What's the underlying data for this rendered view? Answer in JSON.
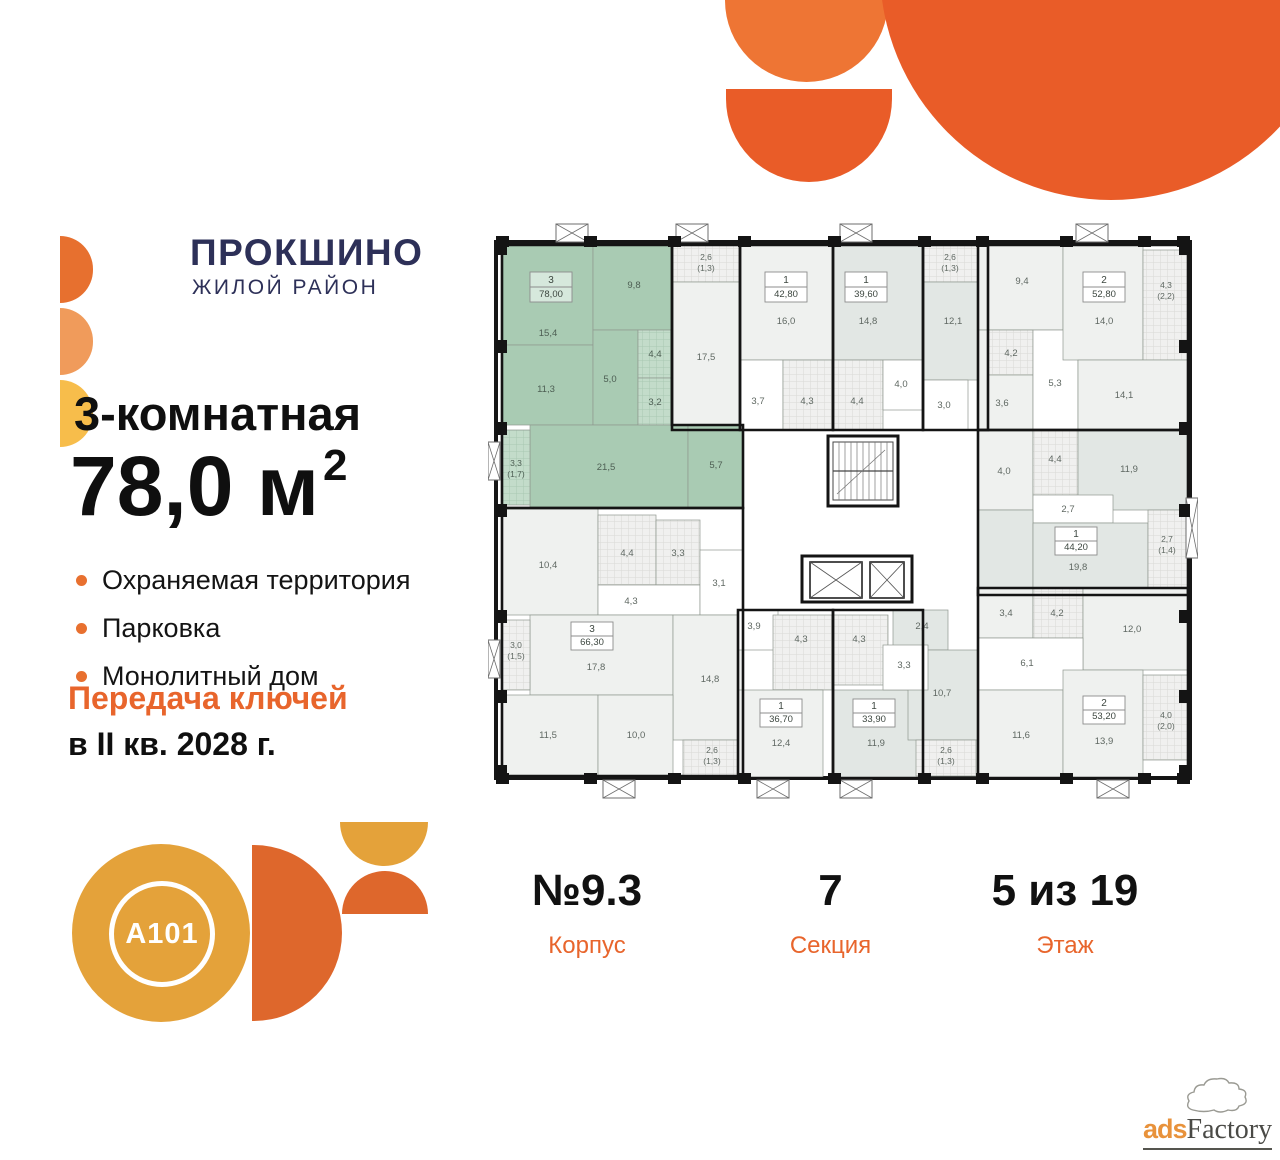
{
  "brand": {
    "name": "ПРОКШИНΟ",
    "subtitle": "ЖИЛОЙ РАЙОН"
  },
  "listing": {
    "rooms_title": "3-комнатная",
    "area_main": "78,0 м",
    "area_sup": "2",
    "features": [
      "Охраняемая территория",
      "Парковка",
      "Монолитный дом"
    ],
    "keys_line1": "Передача ключей",
    "keys_line2": "в II кв. 2028 г."
  },
  "footer": {
    "items": [
      {
        "value": "№9.3",
        "label": "Корпус"
      },
      {
        "value": "7",
        "label": "Секция"
      },
      {
        "value": "5 из 19",
        "label": "Этаж"
      }
    ]
  },
  "developer": {
    "logo_text": "A101"
  },
  "watermark": {
    "prefix": "ads",
    "suffix": "Factory"
  },
  "colors": {
    "accent": "#E8652C",
    "navy": "#2D3058",
    "highlight_green": "#A9CBB3"
  },
  "floorplan": {
    "colors": {
      "green": "#a9cbb3",
      "greenTile": "url(#ptg)",
      "light": "#eff1ef",
      "dark": "#e2e7e4",
      "tile": "url(#pt)",
      "corr": "#ffffff"
    },
    "rooms": [
      {
        "id": "g-15-4",
        "x": 14,
        "y": 25,
        "w": 91,
        "h": 100,
        "f": "green",
        "l": "15,4",
        "lx": 60,
        "ly": 116
      },
      {
        "id": "g-9-8",
        "x": 105,
        "y": 25,
        "w": 79,
        "h": 85,
        "f": "green",
        "l": "9,8",
        "lx": 146,
        "ly": 68
      },
      {
        "id": "g-11-3",
        "x": 14,
        "y": 125,
        "w": 91,
        "h": 80,
        "f": "green",
        "l": "11,3",
        "lx": 58,
        "ly": 172
      },
      {
        "id": "g-5-0",
        "x": 105,
        "y": 110,
        "w": 45,
        "h": 95,
        "f": "green",
        "l": "5,0",
        "lx": 122,
        "ly": 162
      },
      {
        "id": "g-4-4",
        "x": 150,
        "y": 110,
        "w": 34,
        "h": 48,
        "f": "greenTile",
        "l": "4,4",
        "lx": 167,
        "ly": 137
      },
      {
        "id": "g-3-2",
        "x": 150,
        "y": 158,
        "w": 34,
        "h": 47,
        "f": "greenTile",
        "l": "3,2",
        "lx": 167,
        "ly": 185
      },
      {
        "id": "g-21-5",
        "x": 42,
        "y": 205,
        "w": 158,
        "h": 83,
        "f": "green",
        "l": "21,5",
        "lx": 118,
        "ly": 250
      },
      {
        "id": "g-5-7",
        "x": 200,
        "y": 205,
        "w": 55,
        "h": 83,
        "f": "green",
        "l": "5,7",
        "lx": 228,
        "ly": 248
      },
      {
        "id": "g-balc-3-3",
        "x": 14,
        "y": 210,
        "w": 28,
        "h": 75,
        "f": "greenTile",
        "l": "3,3",
        "lx": 28,
        "ly": 246,
        "l2": "(1,7)"
      },
      {
        "id": "t-balc-2-6",
        "x": 184,
        "y": 25,
        "w": 68,
        "h": 37,
        "f": "tile",
        "l": "2,6",
        "lx": 218,
        "ly": 40,
        "l2": "(1,3)"
      },
      {
        "id": "t-17-5",
        "x": 184,
        "y": 62,
        "w": 68,
        "h": 143,
        "f": "light",
        "l": "17,5",
        "lx": 218,
        "ly": 140
      },
      {
        "id": "a-16-0",
        "x": 252,
        "y": 25,
        "w": 93,
        "h": 115,
        "f": "light",
        "l": "16,0",
        "lx": 298,
        "ly": 104
      },
      {
        "id": "a-3-7",
        "x": 252,
        "y": 140,
        "w": 43,
        "h": 70,
        "f": "corr",
        "l": "3,7",
        "lx": 270,
        "ly": 184
      },
      {
        "id": "a-4-3",
        "x": 295,
        "y": 140,
        "w": 50,
        "h": 70,
        "f": "tile",
        "l": "4,3",
        "lx": 319,
        "ly": 184
      },
      {
        "id": "b-14-8",
        "x": 345,
        "y": 25,
        "w": 90,
        "h": 115,
        "f": "dark",
        "l": "14,8",
        "lx": 380,
        "ly": 104
      },
      {
        "id": "b-4-4",
        "x": 345,
        "y": 140,
        "w": 50,
        "h": 70,
        "f": "tile",
        "l": "4,4",
        "lx": 369,
        "ly": 184
      },
      {
        "id": "b-4-0",
        "x": 395,
        "y": 140,
        "w": 40,
        "h": 50,
        "f": "corr",
        "l": "4,0",
        "lx": 413,
        "ly": 167
      },
      {
        "id": "c-balc-2-6",
        "x": 435,
        "y": 25,
        "w": 55,
        "h": 37,
        "f": "tile",
        "l": "2,6",
        "lx": 462,
        "ly": 40,
        "l2": "(1,3)"
      },
      {
        "id": "c-12-1",
        "x": 435,
        "y": 62,
        "w": 65,
        "h": 98,
        "f": "dark",
        "l": "12,1",
        "lx": 465,
        "ly": 104
      },
      {
        "id": "c-3-0",
        "x": 435,
        "y": 160,
        "w": 45,
        "h": 50,
        "f": "corr",
        "l": "3,0",
        "lx": 456,
        "ly": 188
      },
      {
        "id": "d-9-4",
        "x": 490,
        "y": 25,
        "w": 85,
        "h": 85,
        "f": "light",
        "l": "9,4",
        "lx": 534,
        "ly": 64
      },
      {
        "id": "d-3-6",
        "x": 490,
        "y": 110,
        "w": 55,
        "h": 100,
        "f": "light",
        "l": "3,6",
        "lx": 514,
        "ly": 186
      },
      {
        "id": "d-4-2",
        "x": 500,
        "y": 110,
        "w": 45,
        "h": 45,
        "f": "tile",
        "l": "4,2",
        "lx": 523,
        "ly": 136
      },
      {
        "id": "d-5-3",
        "x": 545,
        "y": 110,
        "w": 45,
        "h": 100,
        "f": "corr",
        "l": "5,3",
        "lx": 567,
        "ly": 166
      },
      {
        "id": "d-14-0",
        "x": 575,
        "y": 25,
        "w": 80,
        "h": 115,
        "f": "light",
        "l": "14,0",
        "lx": 616,
        "ly": 104
      },
      {
        "id": "d-balc-4-3",
        "x": 655,
        "y": 30,
        "w": 45,
        "h": 110,
        "f": "tile",
        "l": "4,3",
        "lx": 678,
        "ly": 68,
        "l2": "(2,2)"
      },
      {
        "id": "d-14-1",
        "x": 590,
        "y": 140,
        "w": 110,
        "h": 70,
        "f": "light",
        "l": "14,1",
        "lx": 636,
        "ly": 178
      },
      {
        "id": "e-4-0",
        "x": 490,
        "y": 210,
        "w": 55,
        "h": 80,
        "f": "light",
        "l": "4,0",
        "lx": 516,
        "ly": 254
      },
      {
        "id": "e-4-4",
        "x": 545,
        "y": 210,
        "w": 45,
        "h": 65,
        "f": "tile",
        "l": "4,4",
        "lx": 567,
        "ly": 242
      },
      {
        "id": "e-11-9",
        "x": 590,
        "y": 210,
        "w": 110,
        "h": 80,
        "f": "dark",
        "l": "11,9",
        "lx": 641,
        "ly": 252
      },
      {
        "id": "e-2-7",
        "x": 545,
        "y": 275,
        "w": 80,
        "h": 28,
        "f": "corr",
        "l": "2,7",
        "lx": 580,
        "ly": 292
      },
      {
        "id": "e-kit",
        "x": 490,
        "y": 290,
        "w": 55,
        "h": 85,
        "f": "dark",
        "l": "",
        "lx": 0,
        "ly": 0
      },
      {
        "id": "e-19-8",
        "x": 545,
        "y": 303,
        "w": 115,
        "h": 72,
        "f": "dark",
        "l": "19,8",
        "lx": 590,
        "ly": 350
      },
      {
        "id": "e-balc-2-7",
        "x": 660,
        "y": 290,
        "w": 40,
        "h": 80,
        "f": "tile",
        "l": "2,7",
        "lx": 679,
        "ly": 322,
        "l2": "(1,4)"
      },
      {
        "id": "f-10-4",
        "x": 14,
        "y": 288,
        "w": 96,
        "h": 107,
        "f": "light",
        "l": "10,4",
        "lx": 60,
        "ly": 348
      },
      {
        "id": "f-4-4",
        "x": 110,
        "y": 295,
        "w": 58,
        "h": 70,
        "f": "tile",
        "l": "4,4",
        "lx": 139,
        "ly": 336
      },
      {
        "id": "f-3-3",
        "x": 168,
        "y": 300,
        "w": 44,
        "h": 65,
        "f": "tile",
        "l": "3,3",
        "lx": 190,
        "ly": 336
      },
      {
        "id": "f-4-3",
        "x": 110,
        "y": 365,
        "w": 102,
        "h": 30,
        "f": "corr",
        "l": "4,3",
        "lx": 143,
        "ly": 384
      },
      {
        "id": "f-3-1",
        "x": 212,
        "y": 330,
        "w": 43,
        "h": 65,
        "f": "corr",
        "l": "3,1",
        "lx": 231,
        "ly": 366
      },
      {
        "id": "f-17-8",
        "x": 42,
        "y": 395,
        "w": 143,
        "h": 80,
        "f": "light",
        "l": "17,8",
        "lx": 108,
        "ly": 450
      },
      {
        "id": "f-14-8",
        "x": 185,
        "y": 395,
        "w": 70,
        "h": 125,
        "f": "light",
        "l": "14,8",
        "lx": 222,
        "ly": 462
      },
      {
        "id": "f-balc-3-0",
        "x": 14,
        "y": 400,
        "w": 28,
        "h": 70,
        "f": "tile",
        "l": "3,0",
        "lx": 28,
        "ly": 428,
        "l2": "(1,5)"
      },
      {
        "id": "f-11-5",
        "x": 14,
        "y": 475,
        "w": 96,
        "h": 81,
        "f": "light",
        "l": "11,5",
        "lx": 60,
        "ly": 518
      },
      {
        "id": "f-10-0",
        "x": 110,
        "y": 475,
        "w": 75,
        "h": 81,
        "f": "light",
        "l": "10,0",
        "lx": 148,
        "ly": 518
      },
      {
        "id": "f-balc-2-6",
        "x": 195,
        "y": 520,
        "w": 57,
        "h": 36,
        "f": "tile",
        "l": "2,6",
        "lx": 224,
        "ly": 533,
        "l2": "(1,3)"
      },
      {
        "id": "h-3-9",
        "x": 250,
        "y": 390,
        "w": 40,
        "h": 40,
        "f": "corr",
        "l": "3,9",
        "lx": 266,
        "ly": 409
      },
      {
        "id": "h-4-3",
        "x": 285,
        "y": 395,
        "w": 60,
        "h": 75,
        "f": "tile",
        "l": "4,3",
        "lx": 313,
        "ly": 422
      },
      {
        "id": "h-12-4",
        "x": 250,
        "y": 470,
        "w": 85,
        "h": 88,
        "f": "light",
        "l": "12,4",
        "lx": 293,
        "ly": 526
      },
      {
        "id": "i-4-3",
        "x": 345,
        "y": 395,
        "w": 55,
        "h": 70,
        "f": "tile",
        "l": "4,3",
        "lx": 371,
        "ly": 422
      },
      {
        "id": "i-11-9",
        "x": 345,
        "y": 470,
        "w": 90,
        "h": 88,
        "f": "dark",
        "l": "11,9",
        "lx": 388,
        "ly": 526
      },
      {
        "id": "j-2-4",
        "x": 405,
        "y": 390,
        "w": 55,
        "h": 40,
        "f": "dark",
        "l": "2,4",
        "lx": 434,
        "ly": 409
      },
      {
        "id": "j-10-7",
        "x": 420,
        "y": 430,
        "w": 70,
        "h": 90,
        "f": "dark",
        "l": "10,7",
        "lx": 454,
        "ly": 476
      },
      {
        "id": "j-3-3",
        "x": 395,
        "y": 425,
        "w": 45,
        "h": 45,
        "f": "corr",
        "l": "3,3",
        "lx": 416,
        "ly": 448
      },
      {
        "id": "j-balc-2-6",
        "x": 428,
        "y": 520,
        "w": 60,
        "h": 36,
        "f": "tile",
        "l": "2,6",
        "lx": 458,
        "ly": 533,
        "l2": "(1,3)"
      },
      {
        "id": "k-3-4",
        "x": 490,
        "y": 368,
        "w": 55,
        "h": 50,
        "f": "light",
        "l": "3,4",
        "lx": 518,
        "ly": 396
      },
      {
        "id": "k-4-2",
        "x": 545,
        "y": 368,
        "w": 50,
        "h": 50,
        "f": "tile",
        "l": "4,2",
        "lx": 569,
        "ly": 396
      },
      {
        "id": "k-12-0",
        "x": 595,
        "y": 368,
        "w": 105,
        "h": 82,
        "f": "light",
        "l": "12,0",
        "lx": 644,
        "ly": 412
      },
      {
        "id": "k-6-1",
        "x": 490,
        "y": 418,
        "w": 105,
        "h": 52,
        "f": "corr",
        "l": "6,1",
        "lx": 539,
        "ly": 446
      },
      {
        "id": "k-11-6",
        "x": 490,
        "y": 470,
        "w": 85,
        "h": 88,
        "f": "light",
        "l": "11,6",
        "lx": 533,
        "ly": 518
      },
      {
        "id": "k-13-9",
        "x": 575,
        "y": 450,
        "w": 80,
        "h": 108,
        "f": "light",
        "l": "13,9",
        "lx": 616,
        "ly": 524
      },
      {
        "id": "k-balc-4-0",
        "x": 655,
        "y": 455,
        "w": 45,
        "h": 85,
        "f": "tile",
        "l": "4,0",
        "lx": 678,
        "ly": 498,
        "l2": "(2,0)"
      }
    ],
    "apartments": [
      {
        "type": "3",
        "area": "78,00",
        "green": true,
        "bx": 42,
        "by": 52,
        "bw": 42,
        "bh": 30,
        "poly": "14,25 184,25 184,205 255,205 255,288 14,288"
      },
      {
        "type": "",
        "area": "",
        "poly": "184,25 252,25 252,210 184,210"
      },
      {
        "type": "1",
        "area": "42,80",
        "bx": 277,
        "by": 52,
        "bw": 42,
        "bh": 30,
        "poly": "252,25 345,25 345,210 252,210"
      },
      {
        "type": "1",
        "area": "39,60",
        "bx": 357,
        "by": 52,
        "bw": 42,
        "bh": 30,
        "poly": "345,25 435,25 435,210 345,210"
      },
      {
        "type": "",
        "area": "",
        "poly": "435,25 500,25 500,210 435,210"
      },
      {
        "type": "2",
        "area": "52,80",
        "bx": 595,
        "by": 52,
        "bw": 42,
        "bh": 30,
        "poly": "490,25 700,25 700,210 490,210"
      },
      {
        "type": "1",
        "area": "44,20",
        "bx": 567,
        "by": 307,
        "bw": 42,
        "bh": 28,
        "poly": "490,210 700,210 700,375 490,375"
      },
      {
        "type": "3",
        "area": "66,30",
        "bx": 83,
        "by": 402,
        "bw": 42,
        "bh": 28,
        "poly": "14,288 255,288 255,556 14,556"
      },
      {
        "type": "1",
        "area": "36,70",
        "bx": 272,
        "by": 479,
        "bw": 42,
        "bh": 28,
        "poly": "250,390 345,390 345,558 250,558"
      },
      {
        "type": "1",
        "area": "33,90",
        "bx": 365,
        "by": 479,
        "bw": 42,
        "bh": 28,
        "poly": "345,390 435,390 435,558 345,558"
      },
      {
        "type": "2",
        "area": "53,20",
        "bx": 595,
        "by": 476,
        "bw": 42,
        "bh": 28,
        "poly": "490,368 700,368 700,558 490,558"
      }
    ],
    "core": {
      "walls": [
        [
          340,
          216,
          70,
          70
        ],
        [
          314,
          336,
          110,
          46
        ]
      ],
      "stairs": [
        345,
        222,
        60,
        58
      ],
      "elevators": [
        [
          322,
          342,
          52,
          36
        ],
        [
          382,
          342,
          34,
          36
        ]
      ]
    },
    "xboxes": [
      [
        68,
        4,
        32,
        18
      ],
      [
        188,
        4,
        32,
        18
      ],
      [
        352,
        4,
        32,
        18
      ],
      [
        588,
        4,
        32,
        18
      ],
      [
        115,
        560,
        32,
        18
      ],
      [
        269,
        560,
        32,
        18
      ],
      [
        352,
        560,
        32,
        18
      ],
      [
        609,
        560,
        32,
        18
      ],
      [
        0,
        222,
        12,
        38
      ],
      [
        0,
        420,
        12,
        38
      ],
      [
        698,
        278,
        12,
        60
      ]
    ],
    "piers": [
      [
        8,
        16,
        13,
        11
      ],
      [
        96,
        16,
        13,
        11
      ],
      [
        180,
        16,
        13,
        11
      ],
      [
        250,
        16,
        13,
        11
      ],
      [
        340,
        16,
        13,
        11
      ],
      [
        430,
        16,
        13,
        11
      ],
      [
        488,
        16,
        13,
        11
      ],
      [
        572,
        16,
        13,
        11
      ],
      [
        650,
        16,
        13,
        11
      ],
      [
        689,
        16,
        13,
        11
      ],
      [
        8,
        553,
        13,
        11
      ],
      [
        96,
        553,
        13,
        11
      ],
      [
        180,
        553,
        13,
        11
      ],
      [
        250,
        553,
        13,
        11
      ],
      [
        340,
        553,
        13,
        11
      ],
      [
        430,
        553,
        13,
        11
      ],
      [
        488,
        553,
        13,
        11
      ],
      [
        572,
        553,
        13,
        11
      ],
      [
        650,
        553,
        13,
        11
      ],
      [
        689,
        553,
        13,
        11
      ],
      [
        8,
        22,
        11,
        13
      ],
      [
        8,
        120,
        11,
        13
      ],
      [
        8,
        202,
        11,
        13
      ],
      [
        8,
        284,
        11,
        13
      ],
      [
        8,
        390,
        11,
        13
      ],
      [
        8,
        470,
        11,
        13
      ],
      [
        8,
        545,
        11,
        13
      ],
      [
        691,
        22,
        11,
        13
      ],
      [
        691,
        120,
        11,
        13
      ],
      [
        691,
        202,
        11,
        13
      ],
      [
        691,
        284,
        11,
        13
      ],
      [
        691,
        390,
        11,
        13
      ],
      [
        691,
        470,
        11,
        13
      ],
      [
        691,
        545,
        11,
        13
      ]
    ]
  }
}
